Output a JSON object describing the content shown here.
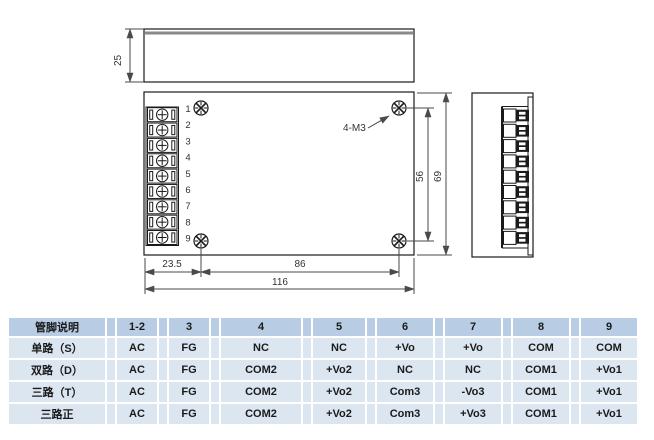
{
  "drawing": {
    "side_view_height": "25",
    "screw_hole_label": "4-M3",
    "dim_screw_vertical_spacing": "56",
    "dim_body_height": "69",
    "dim_left_screw_offset": "23.5",
    "dim_screw_horizontal_spacing": "86",
    "dim_body_width": "116",
    "pin_numbers": [
      "1",
      "2",
      "3",
      "4",
      "5",
      "6",
      "7",
      "8",
      "9"
    ]
  },
  "pin_table": {
    "header": [
      "管脚说明",
      "1-2",
      "3",
      "4",
      "5",
      "6",
      "7",
      "8",
      "9"
    ],
    "rows": [
      {
        "label": "单路（S）",
        "values": [
          "AC",
          "FG",
          "NC",
          "NC",
          "+Vo",
          "+Vo",
          "COM",
          "COM"
        ]
      },
      {
        "label": "双路（D）",
        "values": [
          "AC",
          "FG",
          "COM2",
          "+Vo2",
          "NC",
          "NC",
          "COM1",
          "+Vo1"
        ]
      },
      {
        "label": "三路（T）",
        "values": [
          "AC",
          "FG",
          "COM2",
          "+Vo2",
          "Com3",
          "-Vo3",
          "COM1",
          "+Vo1"
        ]
      },
      {
        "label": "三路正",
        "values": [
          "AC",
          "FG",
          "COM2",
          "+Vo2",
          "Com3",
          "+Vo3",
          "COM1",
          "+Vo1"
        ]
      }
    ]
  },
  "colors": {
    "table_header_bg": "#B8CCE4",
    "table_row_bg": "#DCE6F1",
    "line_color": "#1a1a1a"
  }
}
